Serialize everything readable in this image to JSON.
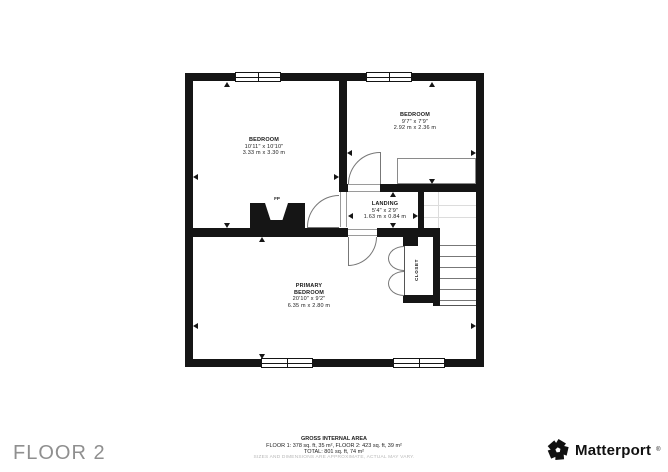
{
  "plan": {
    "rooms": [
      {
        "name": "BEDROOM",
        "dims_ft": "10'11\" x 10'10\"",
        "dims_m": "3.33 m x 3.30 m"
      },
      {
        "name": "BEDROOM",
        "dims_ft": "9'7\" x 7'9\"",
        "dims_m": "2.92 m x 2.36 m"
      },
      {
        "name": "LANDING",
        "dims_ft": "5'4\" x 2'9\"",
        "dims_m": "1.63 m x 0.84 m"
      },
      {
        "name": "PRIMARY",
        "name2": "BEDROOM",
        "dims_ft": "20'10\" x 9'2\"",
        "dims_m": "6.35 m x 2.80 m"
      },
      {
        "name": "CLOSET"
      }
    ],
    "fireplace_label": "FP"
  },
  "footer": {
    "floor_label": "FLOOR 2",
    "area_title": "GROSS INTERNAL AREA",
    "area_line1": "FLOOR 1: 378 sq. ft, 35 m², FLOOR 2: 423 sq. ft, 39 m²",
    "area_line2": "TOTAL: 801 sq. ft, 74 m²",
    "disclaimer": "SIZES AND DIMENSIONS ARE APPROXIMATE, ACTUAL MAY VARY.",
    "brand": {
      "name": "Matterport",
      "mark": "®"
    }
  },
  "colors": {
    "wall": "#151515",
    "door_line": "#777777",
    "faint_line": "#dcdcdc",
    "text": "#1a1a1a",
    "muted_text": "#b8b8b8",
    "floor_label": "#8f8f8f",
    "brand": "#111111"
  }
}
